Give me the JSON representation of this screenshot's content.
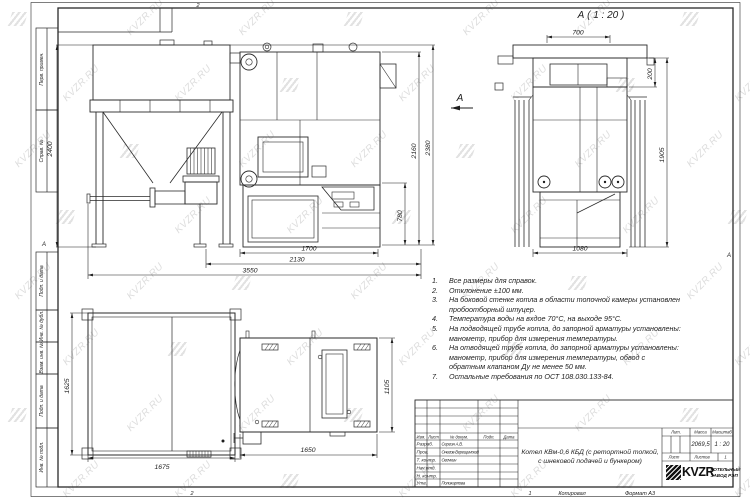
{
  "sheet": {
    "zone_letter": "А",
    "fold_mark_top": "2",
    "fold_mark_bottom_left": "2",
    "fold_mark_bottom_right": "1",
    "copied_label": "Копировал",
    "format_label": "Формат А3"
  },
  "watermark": {
    "text": "KVZR.RU",
    "color": "#c9c9c9"
  },
  "margin_labels": [
    "Перв. примен.",
    "Справ. №",
    "Подп. и дата",
    "Инв. № дубл.",
    "Взам. инв. №",
    "Подп. и дата",
    "Инв. № подл."
  ],
  "views": {
    "front": {
      "view_arrow_label": "А",
      "dims": {
        "total_height": "2400",
        "boiler_height": "2160",
        "overall_height": "2380",
        "ash_height": "780",
        "boiler_length": "1700",
        "mid_length": "2130",
        "total_length": "3550"
      }
    },
    "rear": {
      "title": "А ( 1 : 20 )",
      "dims": {
        "hood_width": "700",
        "hood_height": "200",
        "body_height": "1905",
        "base_width": "1080"
      }
    },
    "bunker_top": {
      "dims": {
        "depth": "1625",
        "width": "1675"
      }
    },
    "boiler_top": {
      "dims": {
        "width": "1650",
        "depth": "1105"
      }
    }
  },
  "notes": {
    "items": [
      {
        "num": "1.",
        "text": "Все размеры для справок."
      },
      {
        "num": "2.",
        "text": "Отклонение ±100 мм."
      },
      {
        "num": "3.",
        "text": "На боковой стенке котла в области топочной камеры установлен пробоотборный штуцер."
      },
      {
        "num": "4.",
        "text": "Температура воды на вхдое 70°С, на выходе 95°С."
      },
      {
        "num": "5.",
        "text": "На подводящей трубе котла, до запорной арматуры установлены: манометр, прибор для измерения температуры."
      },
      {
        "num": "6.",
        "text": "На отводящей трубе котла, до запорной арматуры установлены: манометр, прибор для измерения температуры, обвод с обратным клапаном Ду не менее 50 мм."
      },
      {
        "num": "7.",
        "text": "Остальные требования по ОСТ 108.030.133-84."
      }
    ]
  },
  "title_block": {
    "header": {
      "izm": "Изм.",
      "list": "Лист",
      "doc_no": "№ докум.",
      "podp": "Подп.",
      "data": "Дата"
    },
    "rows": [
      {
        "role": "Разраб.",
        "name": "Сергин А.В."
      },
      {
        "role": "Пров.",
        "name": "Онегов-Верещинский"
      },
      {
        "role": "Т. контр.",
        "name": "Огечкин"
      },
      {
        "role": "Нач.отд.",
        "name": ""
      },
      {
        "role": "Н. контр.",
        "name": ""
      },
      {
        "role": "Утв.",
        "name": "Поликарпова"
      }
    ],
    "doc_title": "Котел КВм-0,6 КБД (с ретортной топкой, с шнековой подачей и бункером)",
    "lit_label": "Лит.",
    "mass_label": "Масса",
    "mass_value": "2069,5",
    "scale_label": "Масштаб",
    "scale_value": "1 : 20",
    "sheet_label": "Лист",
    "sheets_label": "Листов",
    "sheets_value": "1",
    "company": {
      "logo_text": "KVZR",
      "line1": "КОТЕЛЬНЫЙ",
      "line2": "ЗАВОД РЭП"
    }
  }
}
